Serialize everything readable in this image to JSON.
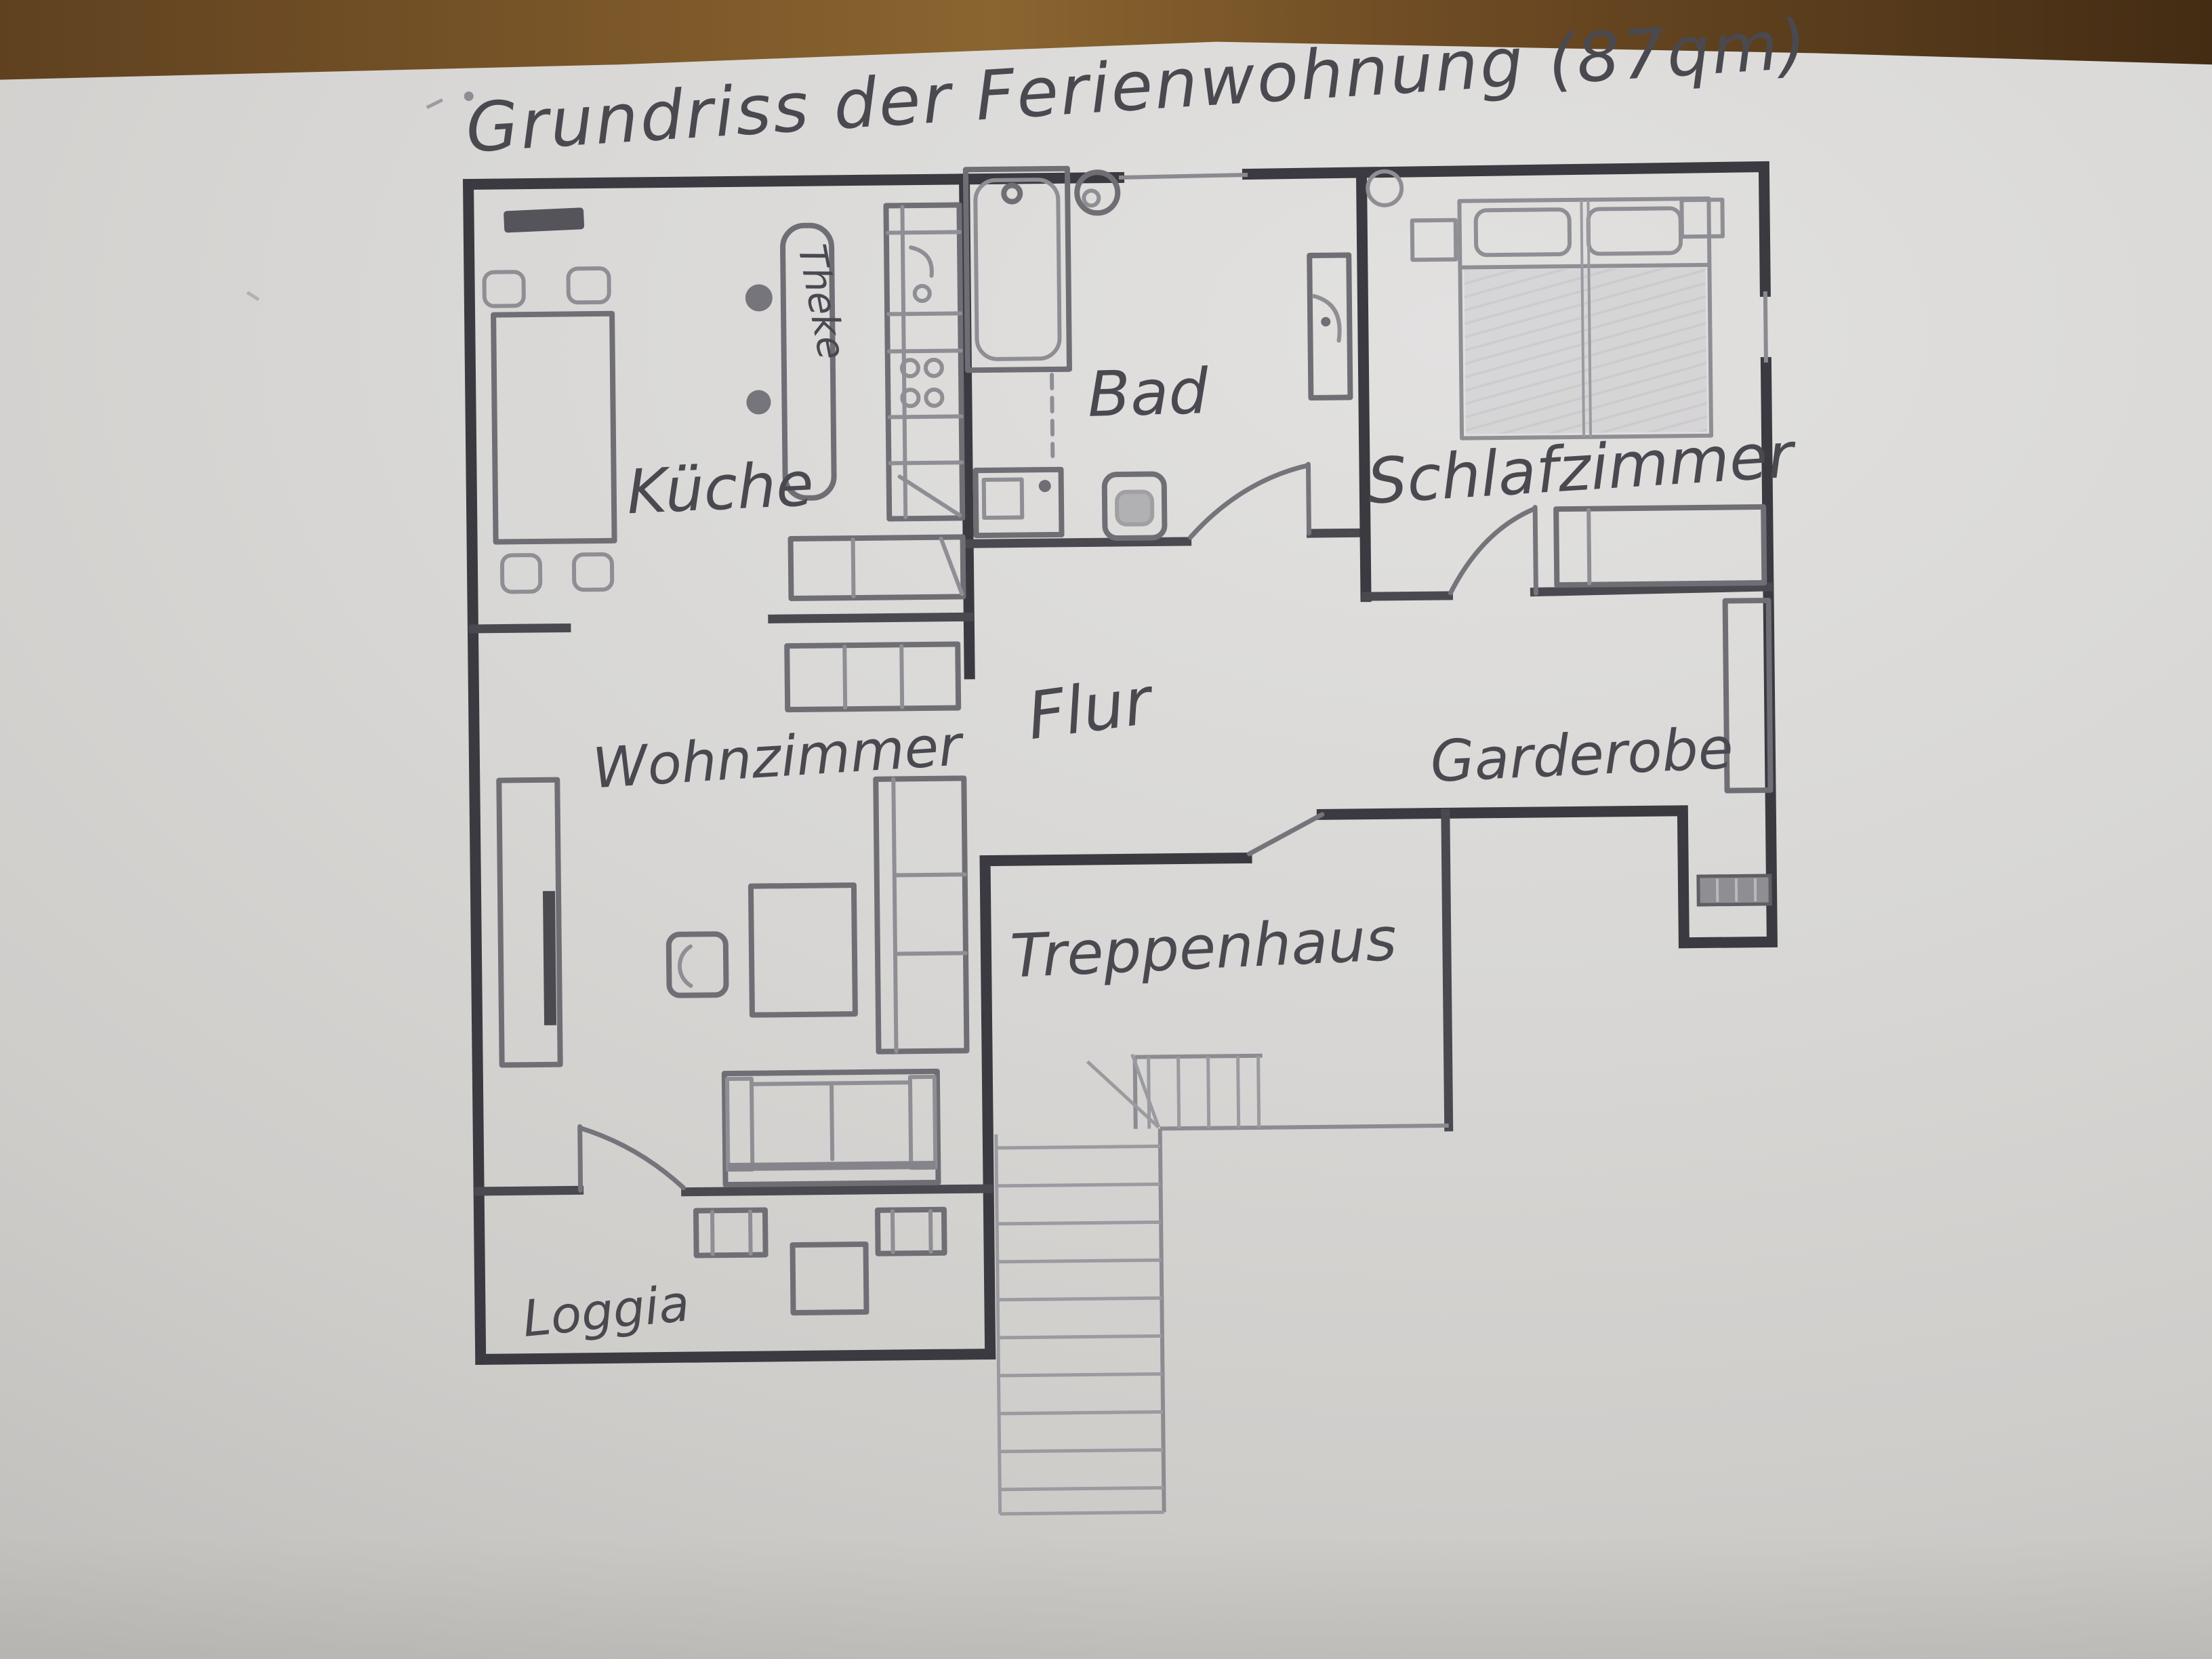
{
  "title": "Grundriss der Ferienwohnung (87qm)",
  "plan": {
    "rooms": {
      "kueche": {
        "label": "Küche"
      },
      "bad": {
        "label": "Bad"
      },
      "schlafzimmer": {
        "label": "Schlafzimmer"
      },
      "flur": {
        "label": "Flur"
      },
      "garderobe": {
        "label": "Garderobe"
      },
      "wohnzimmer": {
        "label": "Wohnzimmer"
      },
      "treppenhaus": {
        "label": "Treppenhaus"
      },
      "loggia": {
        "label": "Loggia"
      }
    },
    "annotations": {
      "theke": {
        "label": "Theke"
      }
    },
    "area_note": "87qm"
  },
  "photo": {
    "colors": {
      "paper": "#d8d7d5",
      "wood-mid": "#7b5729",
      "wood-dark": "#432c13",
      "pencil-wall": "#3b3a40",
      "pencil-mid": "#75747a",
      "pencil-light": "#8f8e94",
      "pencil-label": "#4a4950"
    }
  }
}
